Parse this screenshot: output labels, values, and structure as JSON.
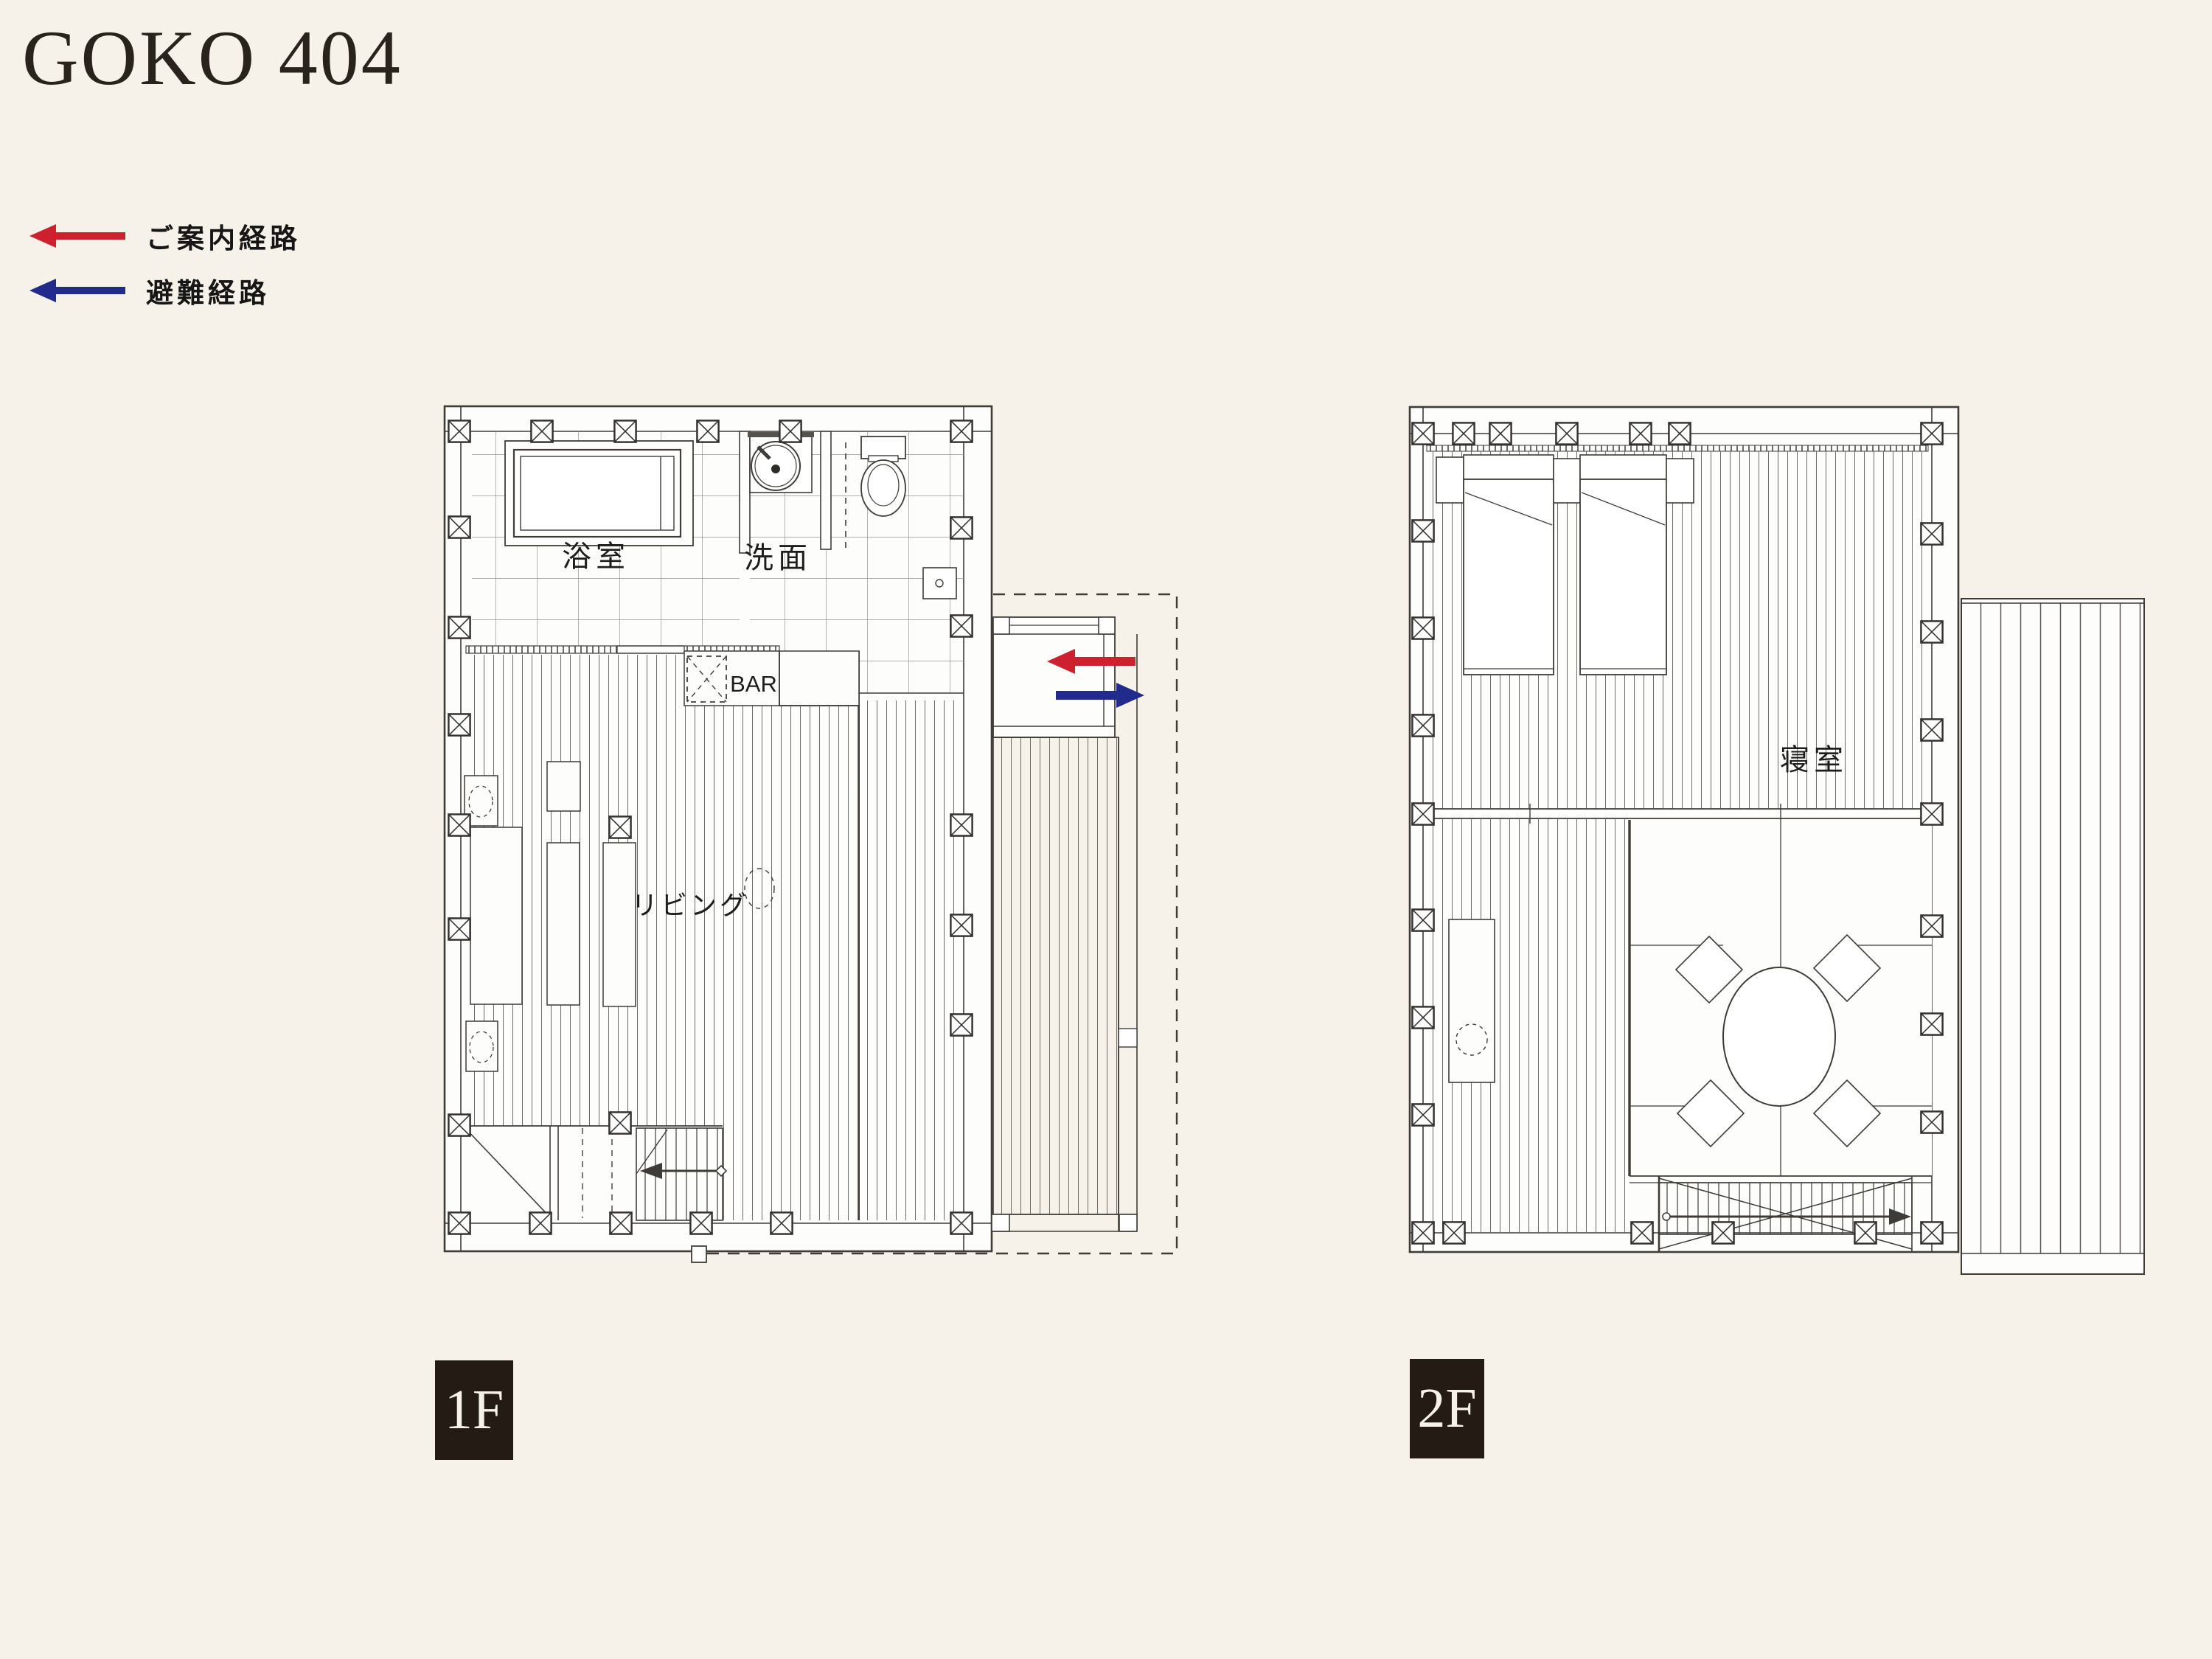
{
  "page": {
    "title": "GOKO 404",
    "background_color": "#f6f2e9"
  },
  "legend": {
    "items": [
      {
        "name": "guide-route",
        "label": "ご案内経路",
        "color": "#ce2130"
      },
      {
        "name": "evacuation-route",
        "label": "避難経路",
        "color": "#202b8c"
      }
    ]
  },
  "floors": [
    {
      "badge": "1F",
      "rooms": {
        "bathroom": "浴室",
        "washroom": "洗面",
        "bar": "BAR",
        "living": "リビング"
      }
    },
    {
      "badge": "2F",
      "rooms": {
        "bedroom": "寝室"
      }
    }
  ],
  "colors": {
    "wall_line": "#3f3c38",
    "paper": "#fdfdfb",
    "badge_bg": "#241b15",
    "badge_text": "#f6f2e9",
    "guide_arrow": "#ce2130",
    "evacuation_arrow": "#202b8c"
  }
}
